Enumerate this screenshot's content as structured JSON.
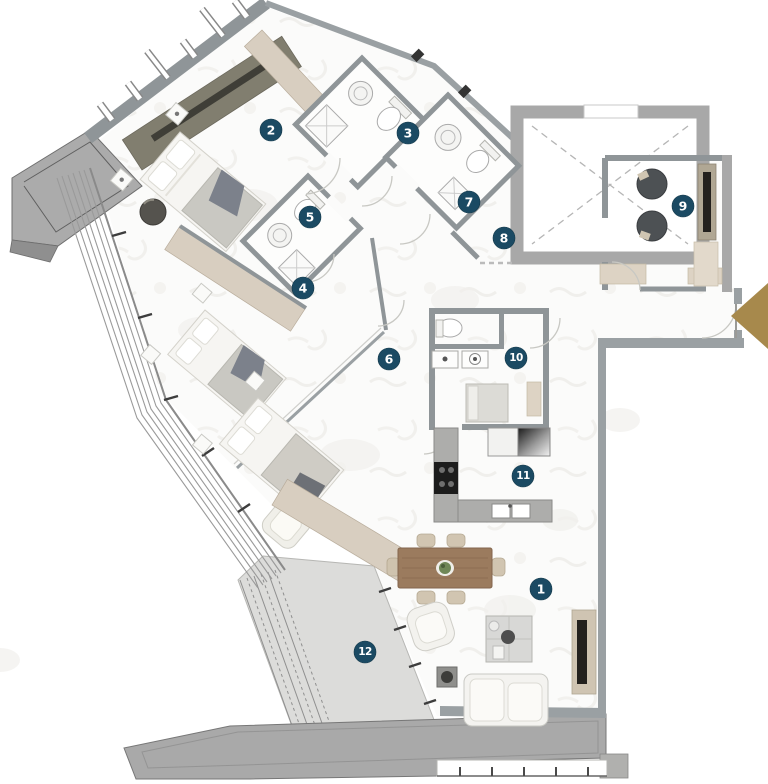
{
  "plan": {
    "type": "residential-apartment-floor-plan",
    "room_markers": [
      {
        "number": "1"
      },
      {
        "number": "2"
      },
      {
        "number": "3"
      },
      {
        "number": "4"
      },
      {
        "number": "5"
      },
      {
        "number": "6"
      },
      {
        "number": "7"
      },
      {
        "number": "8"
      },
      {
        "number": "9"
      },
      {
        "number": "10"
      },
      {
        "number": "11"
      },
      {
        "number": "12"
      }
    ],
    "colors": {
      "marker_badge": "#1b4a63",
      "marker_text": "#ffffff",
      "entrance_arrow": "#a7894c",
      "interior_wall": "#8f9598",
      "core_wall": "#a8a8a8",
      "exterior_slab": "#ababab",
      "wardrobe_beige": "#d8cec0",
      "wardrobe_olive": "#817e6f",
      "balcony_floor": "#dcdcda",
      "floor_marble": "#fbfbfa",
      "counter_gray": "#adadab",
      "dining_table_wood": "#9b7b5e",
      "bed_blanket_gray": "#8f94a0"
    }
  }
}
